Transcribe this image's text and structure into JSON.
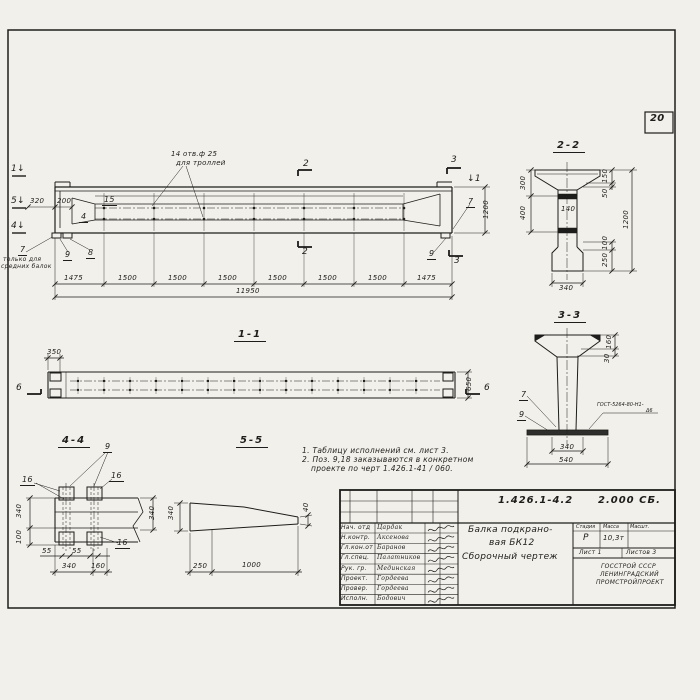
{
  "sheet": {
    "number": "20",
    "paper_color": "#f2f0ea",
    "ink_color": "#1d1d1b"
  },
  "elevation": {
    "cut_marks": {
      "left_1": "1↓",
      "left_5": "5↓",
      "left_4": "4↓",
      "cut2": "2",
      "cut3": "3",
      "right_1": "↓1"
    },
    "holes_note_1": "14 отв.ф 25",
    "holes_note_2": "для троллей",
    "dim_320": "320",
    "dim_200": "200",
    "pos_15": "15",
    "pos_4": "4",
    "pos_7": "7",
    "pos_8": "8",
    "pos_9": "9",
    "note_7_line1": "только для",
    "note_7_line2": "средних балок",
    "dim_1200": "1200",
    "bottom_dims": [
      "1475",
      "1500",
      "1500",
      "1500",
      "1500",
      "1500",
      "1500",
      "1475"
    ],
    "total_dim": "11950"
  },
  "section_2_2": {
    "title": "2-2",
    "dims": {
      "left_300": "300",
      "left_400": "400",
      "right_150": "150",
      "right_50": "50",
      "right_1200": "1200",
      "right_100": "100",
      "right_250": "250",
      "web_140": "140",
      "bottom_340": "340"
    }
  },
  "section_3_3": {
    "title": "3-3",
    "pos_7": "7",
    "pos_9": "9",
    "weld_note_1": "ГОСТ-5264-80-Н1-",
    "weld_note_2": "Δ6",
    "dims": {
      "right_160": "160",
      "right_30": "30",
      "bottom_340": "340",
      "bottom_540": "540"
    }
  },
  "view_1_1": {
    "title": "1-1",
    "cut_6": "6",
    "dims": {
      "left_350": "350",
      "right_650": "650"
    }
  },
  "view_4_4": {
    "title": "4-4",
    "pos_9": "9",
    "pos_16": "16",
    "dims": {
      "left_340": "340",
      "left_100": "100",
      "right_340": "340",
      "b55a": "55",
      "b55b": "55",
      "b340": "340",
      "b160": "160"
    }
  },
  "view_5_5": {
    "title": "5-5",
    "dims": {
      "left_340": "340",
      "tip_40": "40",
      "b250": "250",
      "b1000": "1000"
    }
  },
  "notes": {
    "line1": "1. Таблицу исполнений см. лист 3.",
    "line2": "2. Поз. 9,18 заказываются в конкретном",
    "line3": "проекте по черт 1.426.1-41 / 060."
  },
  "title_block": {
    "doc_number": "1.426.1-4.2",
    "doc_code": "2.000 СБ.",
    "title_line1": "Балка подкрано-",
    "title_line2": "вая БК12",
    "title_line3": "Сборочный чертеж",
    "stage_header": "Стадия",
    "mass_header": "Масса",
    "scale_header": "Масшт.",
    "stage_value": "Р",
    "mass_value": "10,3т",
    "sheet_label": "Лист 1",
    "sheets_label": "Листов 3",
    "org_line1": "ГОССТРОЙ СССР",
    "org_line2": "ЛЕНИНГРАДСКИЙ",
    "org_line3": "ПРОМСТРОЙПРОЕКТ",
    "signature_rows": [
      {
        "role": "Нач. отд",
        "name": "Цардак"
      },
      {
        "role": "Н.контр.",
        "name": "Аксенова"
      },
      {
        "role": "Гл.кон.от",
        "name": "Баранов"
      },
      {
        "role": "Гл.спец.",
        "name": "Палатников"
      },
      {
        "role": "Рук. гр.",
        "name": "Мединская"
      },
      {
        "role": "Проект.",
        "name": "Гордеева"
      },
      {
        "role": "Провер.",
        "name": "Гордеева"
      },
      {
        "role": "Исполн.",
        "name": "Бодович"
      }
    ]
  }
}
